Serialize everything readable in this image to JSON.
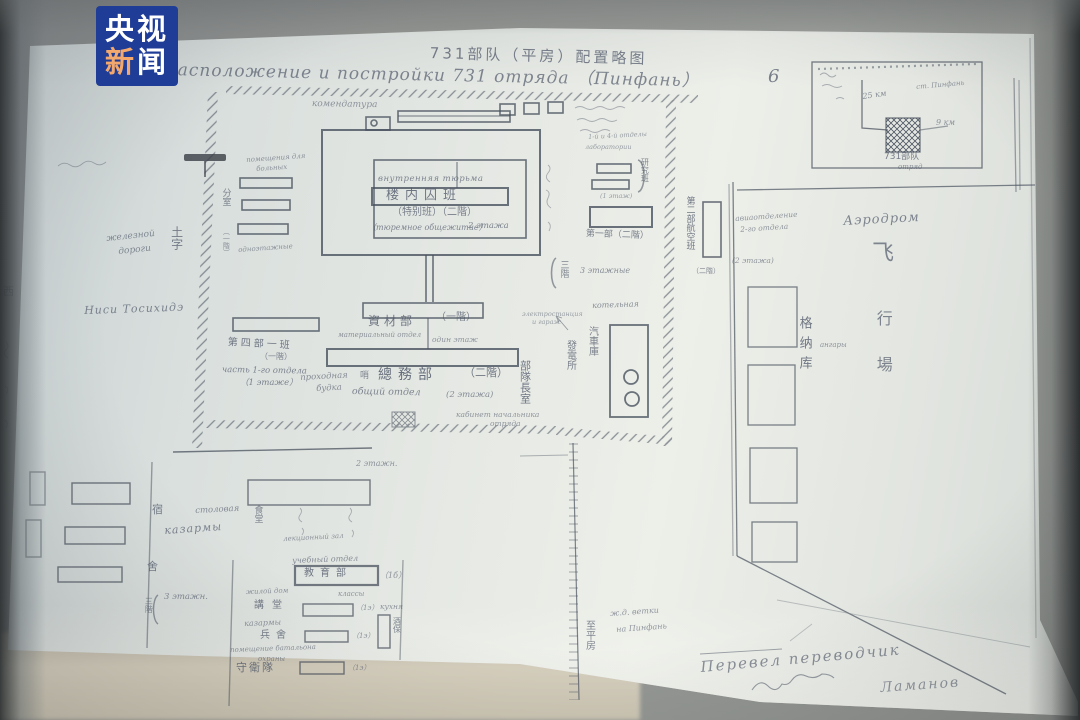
{
  "logo": {
    "l1": "央视",
    "l2a": "新",
    "l2b": "闻"
  },
  "header": {
    "title_zh": "731部队（平房）配置略图",
    "title_ru": "расположение и постройки 731 отряда （Пинфань）",
    "page": "6"
  },
  "inset": {
    "dist": "25 км",
    "station": "ст. Пинфань",
    "dist2": "9 км",
    "unit_zh": "731部队",
    "unit_ru": "отряд"
  },
  "compound": {
    "commandant": "комендатура",
    "inner_ru": "внутренняя тюрьма",
    "inner_zh": "楼内囚班",
    "inner_sub_zh": "（特别班）（二階）",
    "inner_sub_ru": "（тюремное общежитие）",
    "inner_floors": "2 этажа",
    "labs1": "1-й и 4-й отделы",
    "labs2": "лаборатории",
    "labs3": "(1 этаж)",
    "labs_zh": "研究班",
    "part1_zh": "第一部（二階）",
    "three_zh": "三階",
    "three_ru": "3 этажные",
    "sick1": "помещения для",
    "sick2": "больных",
    "sick3": "одноэтажные",
    "sick_zh": "分室",
    "sick_zh2": "（一階）",
    "tu_zh": "土字",
    "rail1": "железной",
    "rail2": "дороги",
    "nishi": "Ниси Тосихидэ",
    "west_zh": "西",
    "part4_zh": "第四部一班",
    "part4_zh2": "（一階）",
    "part4_ru": "часть 1-го отдела",
    "part4_ru2": "（1 этаже）",
    "mat_zh": "資材部",
    "mat_zh2": "（一階）",
    "mat_ru": "материальный отдел",
    "mat_ru2": "один этаж",
    "gen_zh": "總務部",
    "gen_zh2": "（二階）",
    "gen_ru": "общий отдел",
    "gen_ru2": "(2 этажа)",
    "gate1": "проходная",
    "gate2": "будка",
    "gate_zh": "哨",
    "cmd1": "кабинет начальника",
    "cmd2": "отряда",
    "cmd_zh": "部隊長室",
    "boiler": "котельная",
    "power1": "электростанция",
    "power2": "и гараж",
    "garage_zh": "汽車庫",
    "power_zh": "發電所"
  },
  "east": {
    "avia_zh": "第二部航空班",
    "avia_zh2": "（二階）",
    "avia1": "авиаотделение",
    "avia2": "2-го отдела",
    "avia3": "(2 этажа)",
    "aerodrome": "Аэродром",
    "fly_zh": "飞",
    "hangar_zh": "格纳库",
    "hangar_ru": "ангары",
    "field_zh": "行場"
  },
  "south": {
    "floors2": "2 этажн.",
    "dorm1": "宿",
    "dorm2": "舍",
    "barracks": "казармы",
    "canteen": "столовая",
    "canteen_zh": "食堂",
    "lecture": "лекционный зал",
    "training": "учебный отдел",
    "training_zh": "教育部",
    "training_note": "（1б）",
    "row2a": "жилой дом",
    "row2b": "классы",
    "row2_zh": "講堂",
    "row2_note": "（1э）",
    "kitchen": "кухня",
    "row3": "казармы",
    "row3_zh": "兵舍",
    "row3_note": "（1э）",
    "side_zh": "酒保",
    "row4a": "помещение батальона",
    "row4b": "охраны",
    "row4_zh": "守衛隊",
    "row4_note": "（1э）",
    "three": "3 этажн.",
    "three_zh": "三階"
  },
  "railway": {
    "b1": "ж.д. ветки",
    "b2": "на Пинфань",
    "to_zh": "至平房"
  },
  "signature": {
    "s1": "Перевел переводчик",
    "s2": "Ламанов"
  }
}
